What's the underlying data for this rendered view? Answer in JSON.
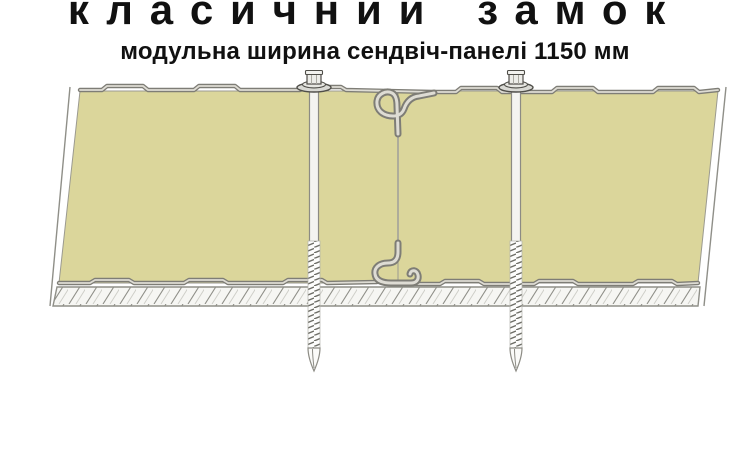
{
  "header": {
    "title": "класичний замок",
    "subtitle": "модульна ширина сендвіч-панелі 1150 мм"
  },
  "diagram": {
    "type": "technical-cross-section",
    "subject": "sandwich-panel classic lock joint, modular panel width 1150 mm",
    "elements": [
      "left sandwich panel (mineral wool core)",
      "right sandwich panel (mineral wool core)",
      "classic lock joint (interlocking S-profiles, top and bottom)",
      "self-drilling screw through left panel",
      "self-drilling screw through right panel",
      "hatched support member under panels"
    ],
    "colors": {
      "background": "#ffffff",
      "text": "#111111",
      "panel-core": "#dbd69b",
      "sheet-metal": "#7e7d76",
      "sheet-highlight": "#dedcd4",
      "outline": "#4f4e49",
      "hatch": "#8f8f88"
    }
  }
}
